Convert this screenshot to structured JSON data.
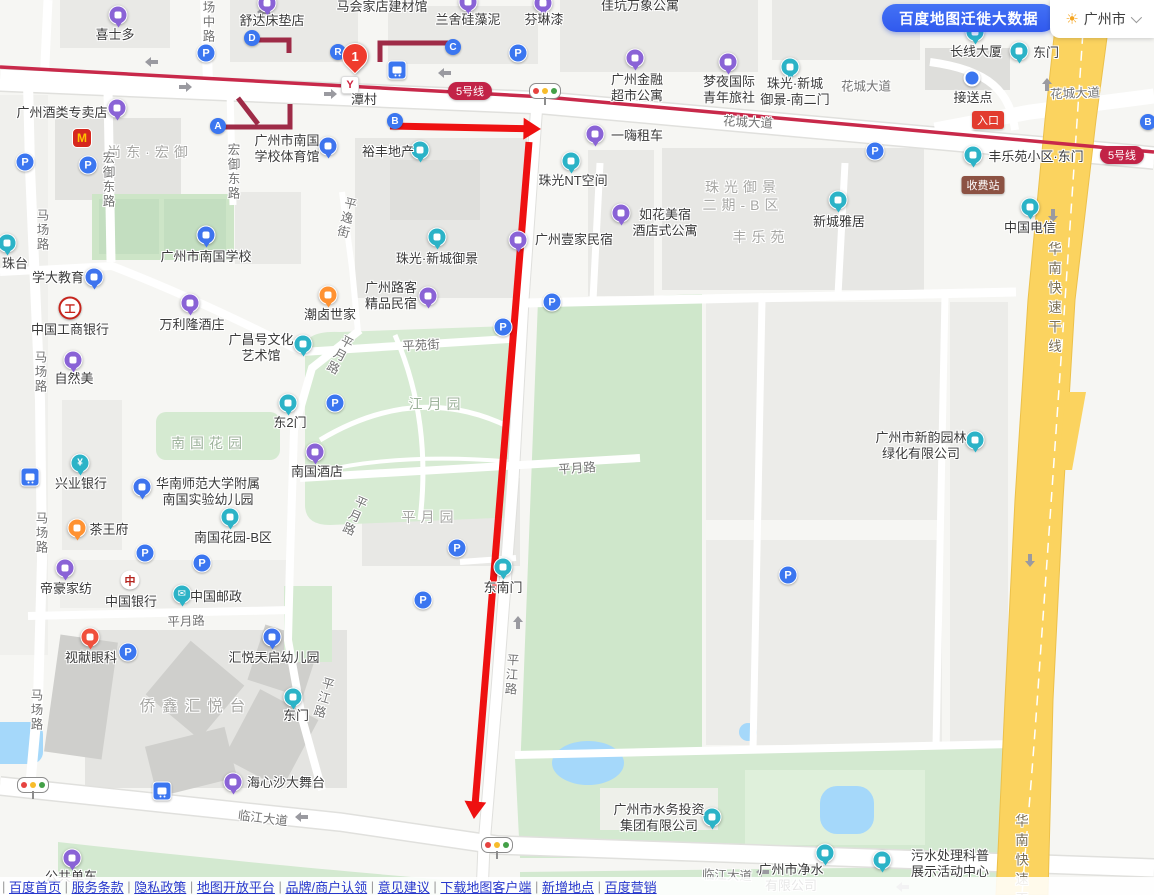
{
  "header": {
    "migration_button": "百度地图迁徙大数据",
    "city": "广州市"
  },
  "map": {
    "colors": {
      "purple": "#8a63d6",
      "cyan": "#2cb3c7",
      "blue": "#3f74ee",
      "orange": "#ff9232",
      "red": "#f0503c",
      "metro_line": "#c8294a",
      "construction_line": "#9e2b47",
      "annotation": "#ee1111",
      "highway": "#fbd35f"
    },
    "station": {
      "name": "潭村",
      "route_number": "1"
    },
    "badges": [
      {
        "text": "5号线",
        "x": 470,
        "y": 91,
        "bg": "#c22347",
        "kind": "line"
      },
      {
        "text": "5号线",
        "x": 1122,
        "y": 155,
        "bg": "#c22347",
        "kind": "line"
      },
      {
        "text": "入口",
        "x": 988,
        "y": 120,
        "bg": "#e23c2f",
        "kind": "entrance"
      },
      {
        "text": "收费站",
        "x": 983,
        "y": 185,
        "bg": "#8c5243",
        "kind": "toll"
      }
    ],
    "areas": [
      {
        "t": "尚东·宏御",
        "x": 150,
        "y": 152,
        "k": "block"
      },
      {
        "t": "珠光御景\n二期-B区",
        "x": 743,
        "y": 196,
        "k": "block"
      },
      {
        "t": "丰乐苑",
        "x": 761,
        "y": 237,
        "k": "block"
      },
      {
        "t": "南国花园",
        "x": 209,
        "y": 443,
        "k": "park"
      },
      {
        "t": "江月园",
        "x": 437,
        "y": 404,
        "k": "park"
      },
      {
        "t": "平月园",
        "x": 430,
        "y": 517,
        "k": "block"
      },
      {
        "t": "侨鑫汇悦台",
        "x": 196,
        "y": 707,
        "k": "block big"
      }
    ],
    "roads": [
      {
        "t": "场中路",
        "x": 208,
        "y": 22,
        "v": 1,
        "r": 0
      },
      {
        "t": "宏御东路",
        "x": 108,
        "y": 180,
        "v": 1,
        "r": 0
      },
      {
        "t": "宏御东路",
        "x": 233,
        "y": 172,
        "v": 1,
        "r": 0
      },
      {
        "t": "马场路",
        "x": 42,
        "y": 230,
        "v": 1,
        "r": 0
      },
      {
        "t": "马场路",
        "x": 40,
        "y": 372,
        "v": 1,
        "r": 0
      },
      {
        "t": "马场路",
        "x": 41,
        "y": 533,
        "v": 1,
        "r": 0
      },
      {
        "t": "马场路",
        "x": 36,
        "y": 710,
        "v": 1,
        "r": 0
      },
      {
        "t": "平逸街",
        "x": 346,
        "y": 218,
        "v": 1,
        "r": 14
      },
      {
        "t": "平苑街",
        "x": 421,
        "y": 344,
        "v": 0,
        "r": -3
      },
      {
        "t": "平月路",
        "x": 339,
        "y": 355,
        "v": 1,
        "r": 28
      },
      {
        "t": "平月路",
        "x": 354,
        "y": 516,
        "v": 1,
        "r": 24
      },
      {
        "t": "平月路",
        "x": 577,
        "y": 467,
        "v": 0,
        "r": -4
      },
      {
        "t": "平月路",
        "x": 186,
        "y": 620,
        "v": 0,
        "r": -2
      },
      {
        "t": "平江路",
        "x": 323,
        "y": 698,
        "v": 1,
        "r": 16
      },
      {
        "t": "平江路",
        "x": 511,
        "y": 675,
        "v": 1,
        "r": 4
      },
      {
        "t": "临江大道",
        "x": 263,
        "y": 817,
        "v": 0,
        "r": 7
      },
      {
        "t": "临江大道",
        "x": 727,
        "y": 874,
        "v": 0,
        "r": 2
      },
      {
        "t": "花城大道",
        "x": 748,
        "y": 121,
        "v": 0,
        "r": 3
      },
      {
        "t": "花城大道",
        "x": 866,
        "y": 85,
        "v": 0,
        "r": 0
      },
      {
        "t": "花城大道",
        "x": 1075,
        "y": 92,
        "v": 0,
        "r": -2
      },
      {
        "t": "华南快速干线",
        "x": 1053,
        "y": 300,
        "v": 1,
        "r": 0,
        "k": "hwy"
      },
      {
        "t": "华南快速干线",
        "x": 1020,
        "y": 872,
        "v": 1,
        "r": 0,
        "k": "hwy"
      }
    ],
    "pois": [
      {
        "t": "喜士多",
        "i": "pin",
        "c": "#8a63d6",
        "ip": [
          118,
          15
        ],
        "lp": [
          115,
          35
        ]
      },
      {
        "t": "舒达床垫店",
        "i": "pin",
        "c": "#8a63d6",
        "ip": [
          267,
          3
        ],
        "lp": [
          272,
          21
        ]
      },
      {
        "t": "马会家店建材馆",
        "lp": [
          382,
          7
        ]
      },
      {
        "t": "兰舍硅藻泥",
        "i": "pin",
        "c": "#8a63d6",
        "ip": [
          468,
          2
        ],
        "lp": [
          468,
          20
        ]
      },
      {
        "t": "芬琳漆",
        "i": "pin",
        "c": "#8a63d6",
        "ip": [
          543,
          3
        ],
        "lp": [
          544,
          20
        ]
      },
      {
        "t": "佳坑万象公寓",
        "lp": [
          640,
          6
        ]
      },
      {
        "t": "广州金融\n超市公寓",
        "i": "pin",
        "c": "#8a63d6",
        "ip": [
          635,
          58
        ],
        "lp": [
          637,
          88
        ]
      },
      {
        "t": "梦夜国际\n青年旅社",
        "i": "pin",
        "c": "#8a63d6",
        "ip": [
          728,
          62
        ],
        "lp": [
          729,
          90
        ]
      },
      {
        "t": "珠光·新城\n御景-南二门",
        "i": "pin",
        "c": "#2cb3c7",
        "ip": [
          790,
          67
        ],
        "lp": [
          795,
          92
        ]
      },
      {
        "t": "长线大厦",
        "i": "pin",
        "c": "#2cb3c7",
        "ip": [
          975,
          32
        ],
        "lp": [
          976,
          52
        ]
      },
      {
        "t": "东门",
        "i": "pin",
        "c": "#2cb3c7",
        "ip": [
          1019,
          51
        ],
        "lp": [
          1046,
          53
        ]
      },
      {
        "t": "接送点",
        "i": "dot",
        "c": "#3b76f0",
        "ip": [
          972,
          78
        ],
        "lp": [
          973,
          98
        ]
      },
      {
        "t": "丰乐苑小区·东门",
        "i": "pin",
        "c": "#2cb3c7",
        "ip": [
          973,
          155
        ],
        "lp": [
          1036,
          157
        ]
      },
      {
        "t": "中国电信",
        "i": "pin",
        "c": "#2cb3c7",
        "ip": [
          1030,
          207
        ],
        "lp": [
          1030,
          228
        ]
      },
      {
        "t": "广州酒类专卖店",
        "i": "pin",
        "c": "#8a63d6",
        "ip": [
          117,
          108
        ],
        "lp": [
          62,
          113
        ]
      },
      {
        "t": "",
        "i": "mc",
        "g": "M",
        "ip": [
          82,
          138
        ],
        "lp": [
          82,
          138
        ],
        "n": "mcdonalds-icon"
      },
      {
        "t": "广州市南国\n学校体育馆",
        "i": "pin",
        "c": "#3f74ee",
        "ip": [
          328,
          146
        ],
        "lp": [
          287,
          149
        ]
      },
      {
        "t": "裕丰地产",
        "i": "pin",
        "c": "#2cb3c7",
        "ip": [
          420,
          150
        ],
        "lp": [
          388,
          152
        ]
      },
      {
        "t": "潭村",
        "i": "metro",
        "g": "Y",
        "ip": [
          350,
          85
        ],
        "lp": [
          364,
          100
        ]
      },
      {
        "t": "一嗨租车",
        "i": "pin",
        "c": "#8a63d6",
        "ip": [
          595,
          134
        ],
        "lp": [
          637,
          136
        ]
      },
      {
        "t": "珠光NT空间",
        "i": "pin",
        "c": "#2cb3c7",
        "ip": [
          571,
          161
        ],
        "lp": [
          573,
          181
        ]
      },
      {
        "t": "如花美宿\n酒店式公寓",
        "i": "pin",
        "c": "#8a63d6",
        "ip": [
          621,
          213
        ],
        "lp": [
          665,
          223
        ]
      },
      {
        "t": "新城雅居",
        "i": "pin",
        "c": "#2cb3c7",
        "ip": [
          838,
          200
        ],
        "lp": [
          839,
          222
        ]
      },
      {
        "t": "广州壹家民宿",
        "i": "pin",
        "c": "#8a63d6",
        "ip": [
          518,
          240
        ],
        "lp": [
          574,
          240
        ]
      },
      {
        "t": "珠光·新城御景",
        "i": "pin",
        "c": "#2cb3c7",
        "ip": [
          437,
          237
        ],
        "lp": [
          437,
          259
        ]
      },
      {
        "t": "广州路客\n精品民宿",
        "i": "pin",
        "c": "#8a63d6",
        "ip": [
          428,
          296
        ],
        "lp": [
          391,
          296
        ]
      },
      {
        "t": "潮卤世家",
        "i": "pin",
        "c": "#ff9232",
        "ip": [
          328,
          295
        ],
        "lp": [
          330,
          315
        ]
      },
      {
        "t": "万利隆酒庄",
        "i": "pin",
        "c": "#8a63d6",
        "ip": [
          190,
          303
        ],
        "lp": [
          192,
          325
        ]
      },
      {
        "t": "广昌号文化\n艺术馆",
        "i": "pin",
        "c": "#2cb3c7",
        "ip": [
          303,
          344
        ],
        "lp": [
          261,
          348
        ]
      },
      {
        "t": "中国工商银行",
        "i": "icbc",
        "g": "工",
        "ip": [
          70,
          308
        ],
        "lp": [
          70,
          330
        ]
      },
      {
        "t": "学大教育",
        "i": "pin",
        "c": "#3f74ee",
        "ip": [
          94,
          277
        ],
        "lp": [
          58,
          278
        ]
      },
      {
        "t": "广州市南国学校",
        "i": "pin",
        "c": "#3f74ee",
        "ip": [
          206,
          235
        ],
        "lp": [
          206,
          257
        ]
      },
      {
        "t": "自然美",
        "i": "pin",
        "c": "#8a63d6",
        "ip": [
          73,
          360
        ],
        "lp": [
          74,
          379
        ]
      },
      {
        "t": "珠台",
        "i": "pin",
        "c": "#2cb3c7",
        "ip": [
          7,
          243
        ],
        "lp": [
          15,
          264
        ]
      },
      {
        "t": "东2门",
        "i": "pin",
        "c": "#2cb3c7",
        "ip": [
          288,
          403
        ],
        "lp": [
          290,
          423
        ]
      },
      {
        "t": "南国酒店",
        "i": "pin",
        "c": "#8a63d6",
        "ip": [
          315,
          452
        ],
        "lp": [
          317,
          472
        ]
      },
      {
        "t": "兴业银行",
        "i": "pin",
        "c": "#2cb3c7",
        "g": "¥",
        "ip": [
          80,
          463
        ],
        "lp": [
          81,
          484
        ]
      },
      {
        "t": "华南师范大学附属\n南国实验幼儿园",
        "i": "pin",
        "c": "#3f74ee",
        "ip": [
          142,
          487
        ],
        "lp": [
          208,
          492
        ]
      },
      {
        "t": "南国花园-B区",
        "i": "pin",
        "c": "#2cb3c7",
        "ip": [
          230,
          517
        ],
        "lp": [
          233,
          538
        ]
      },
      {
        "t": "茶王府",
        "i": "pin",
        "c": "#ff9232",
        "ip": [
          77,
          528
        ],
        "lp": [
          109,
          530
        ]
      },
      {
        "t": "帝豪家纺",
        "i": "pin",
        "c": "#8a63d6",
        "ip": [
          65,
          568
        ],
        "lp": [
          66,
          589
        ]
      },
      {
        "t": "中国银行",
        "i": "boc",
        "g": "中",
        "ip": [
          130,
          580
        ],
        "lp": [
          131,
          602
        ]
      },
      {
        "t": "中国邮政",
        "i": "pin",
        "c": "#2cb3c7",
        "g": "✉",
        "ip": [
          182,
          594
        ],
        "lp": [
          216,
          597
        ]
      },
      {
        "t": "视献眼科",
        "i": "pin",
        "c": "#f0503c",
        "ip": [
          90,
          637
        ],
        "lp": [
          91,
          658
        ]
      },
      {
        "t": "汇悦天启幼儿园",
        "i": "pin",
        "c": "#3f74ee",
        "ip": [
          272,
          637
        ],
        "lp": [
          274,
          658
        ]
      },
      {
        "t": "东门",
        "i": "pin",
        "c": "#2cb3c7",
        "ip": [
          293,
          697
        ],
        "lp": [
          296,
          716
        ]
      },
      {
        "t": "东南门",
        "i": "pin",
        "c": "#2cb3c7",
        "ip": [
          503,
          567
        ],
        "lp": [
          503,
          588
        ]
      },
      {
        "t": "海心沙大舞台",
        "i": "pin",
        "c": "#8a63d6",
        "ip": [
          233,
          782
        ],
        "lp": [
          286,
          783
        ]
      },
      {
        "t": "公共单车",
        "i": "pin",
        "c": "#8a63d6",
        "ip": [
          72,
          858
        ],
        "lp": [
          71,
          877
        ]
      },
      {
        "t": "广州市水务投资\n集团有限公司",
        "i": "pin",
        "c": "#2cb3c7",
        "ip": [
          712,
          817
        ],
        "lp": [
          659,
          818
        ]
      },
      {
        "t": "广州市净水\n有限公司",
        "i": "pin",
        "c": "#2cb3c7",
        "ip": [
          825,
          853
        ],
        "lp": [
          791,
          878
        ]
      },
      {
        "t": "污水处理科普\n展示活动中心",
        "i": "pin",
        "c": "#2cb3c7",
        "ip": [
          882,
          860
        ],
        "lp": [
          950,
          864
        ]
      },
      {
        "t": "广州市新韵园林\n绿化有限公司",
        "i": "pin",
        "c": "#2cb3c7",
        "ip": [
          975,
          440
        ],
        "lp": [
          921,
          446
        ]
      }
    ],
    "letters": [
      {
        "t": "A",
        "x": 218,
        "y": 126
      },
      {
        "t": "B",
        "x": 395,
        "y": 121
      },
      {
        "t": "C",
        "x": 453,
        "y": 47
      },
      {
        "t": "D",
        "x": 252,
        "y": 38
      },
      {
        "t": "R",
        "x": 338,
        "y": 52
      },
      {
        "t": "B",
        "x": 1148,
        "y": 122
      }
    ],
    "parking": [
      [
        206,
        53
      ],
      [
        518,
        53
      ],
      [
        875,
        151
      ],
      [
        25,
        162
      ],
      [
        88,
        165
      ],
      [
        552,
        302
      ],
      [
        503,
        327
      ],
      [
        335,
        403
      ],
      [
        145,
        553
      ],
      [
        202,
        563
      ],
      [
        128,
        652
      ],
      [
        457,
        548
      ],
      [
        423,
        600
      ],
      [
        788,
        575
      ]
    ],
    "bus_stops": [
      [
        397,
        70
      ],
      [
        30,
        477
      ],
      [
        162,
        791
      ]
    ],
    "traffic_lights": [
      [
        545,
        91
      ],
      [
        33,
        785
      ],
      [
        497,
        845
      ]
    ],
    "annotations": {
      "arrow1": {
        "from": [
          390,
          126
        ],
        "to": [
          540,
          129
        ]
      },
      "arrow2": {
        "from": [
          529,
          142
        ],
        "to": [
          474,
          818
        ]
      }
    }
  },
  "footer": {
    "links": [
      "百度首页",
      "服务条款",
      "隐私政策",
      "地图开放平台",
      "品牌/商户认领",
      "意见建议",
      "下载地图客户端",
      "新增地点",
      "百度营销"
    ]
  }
}
